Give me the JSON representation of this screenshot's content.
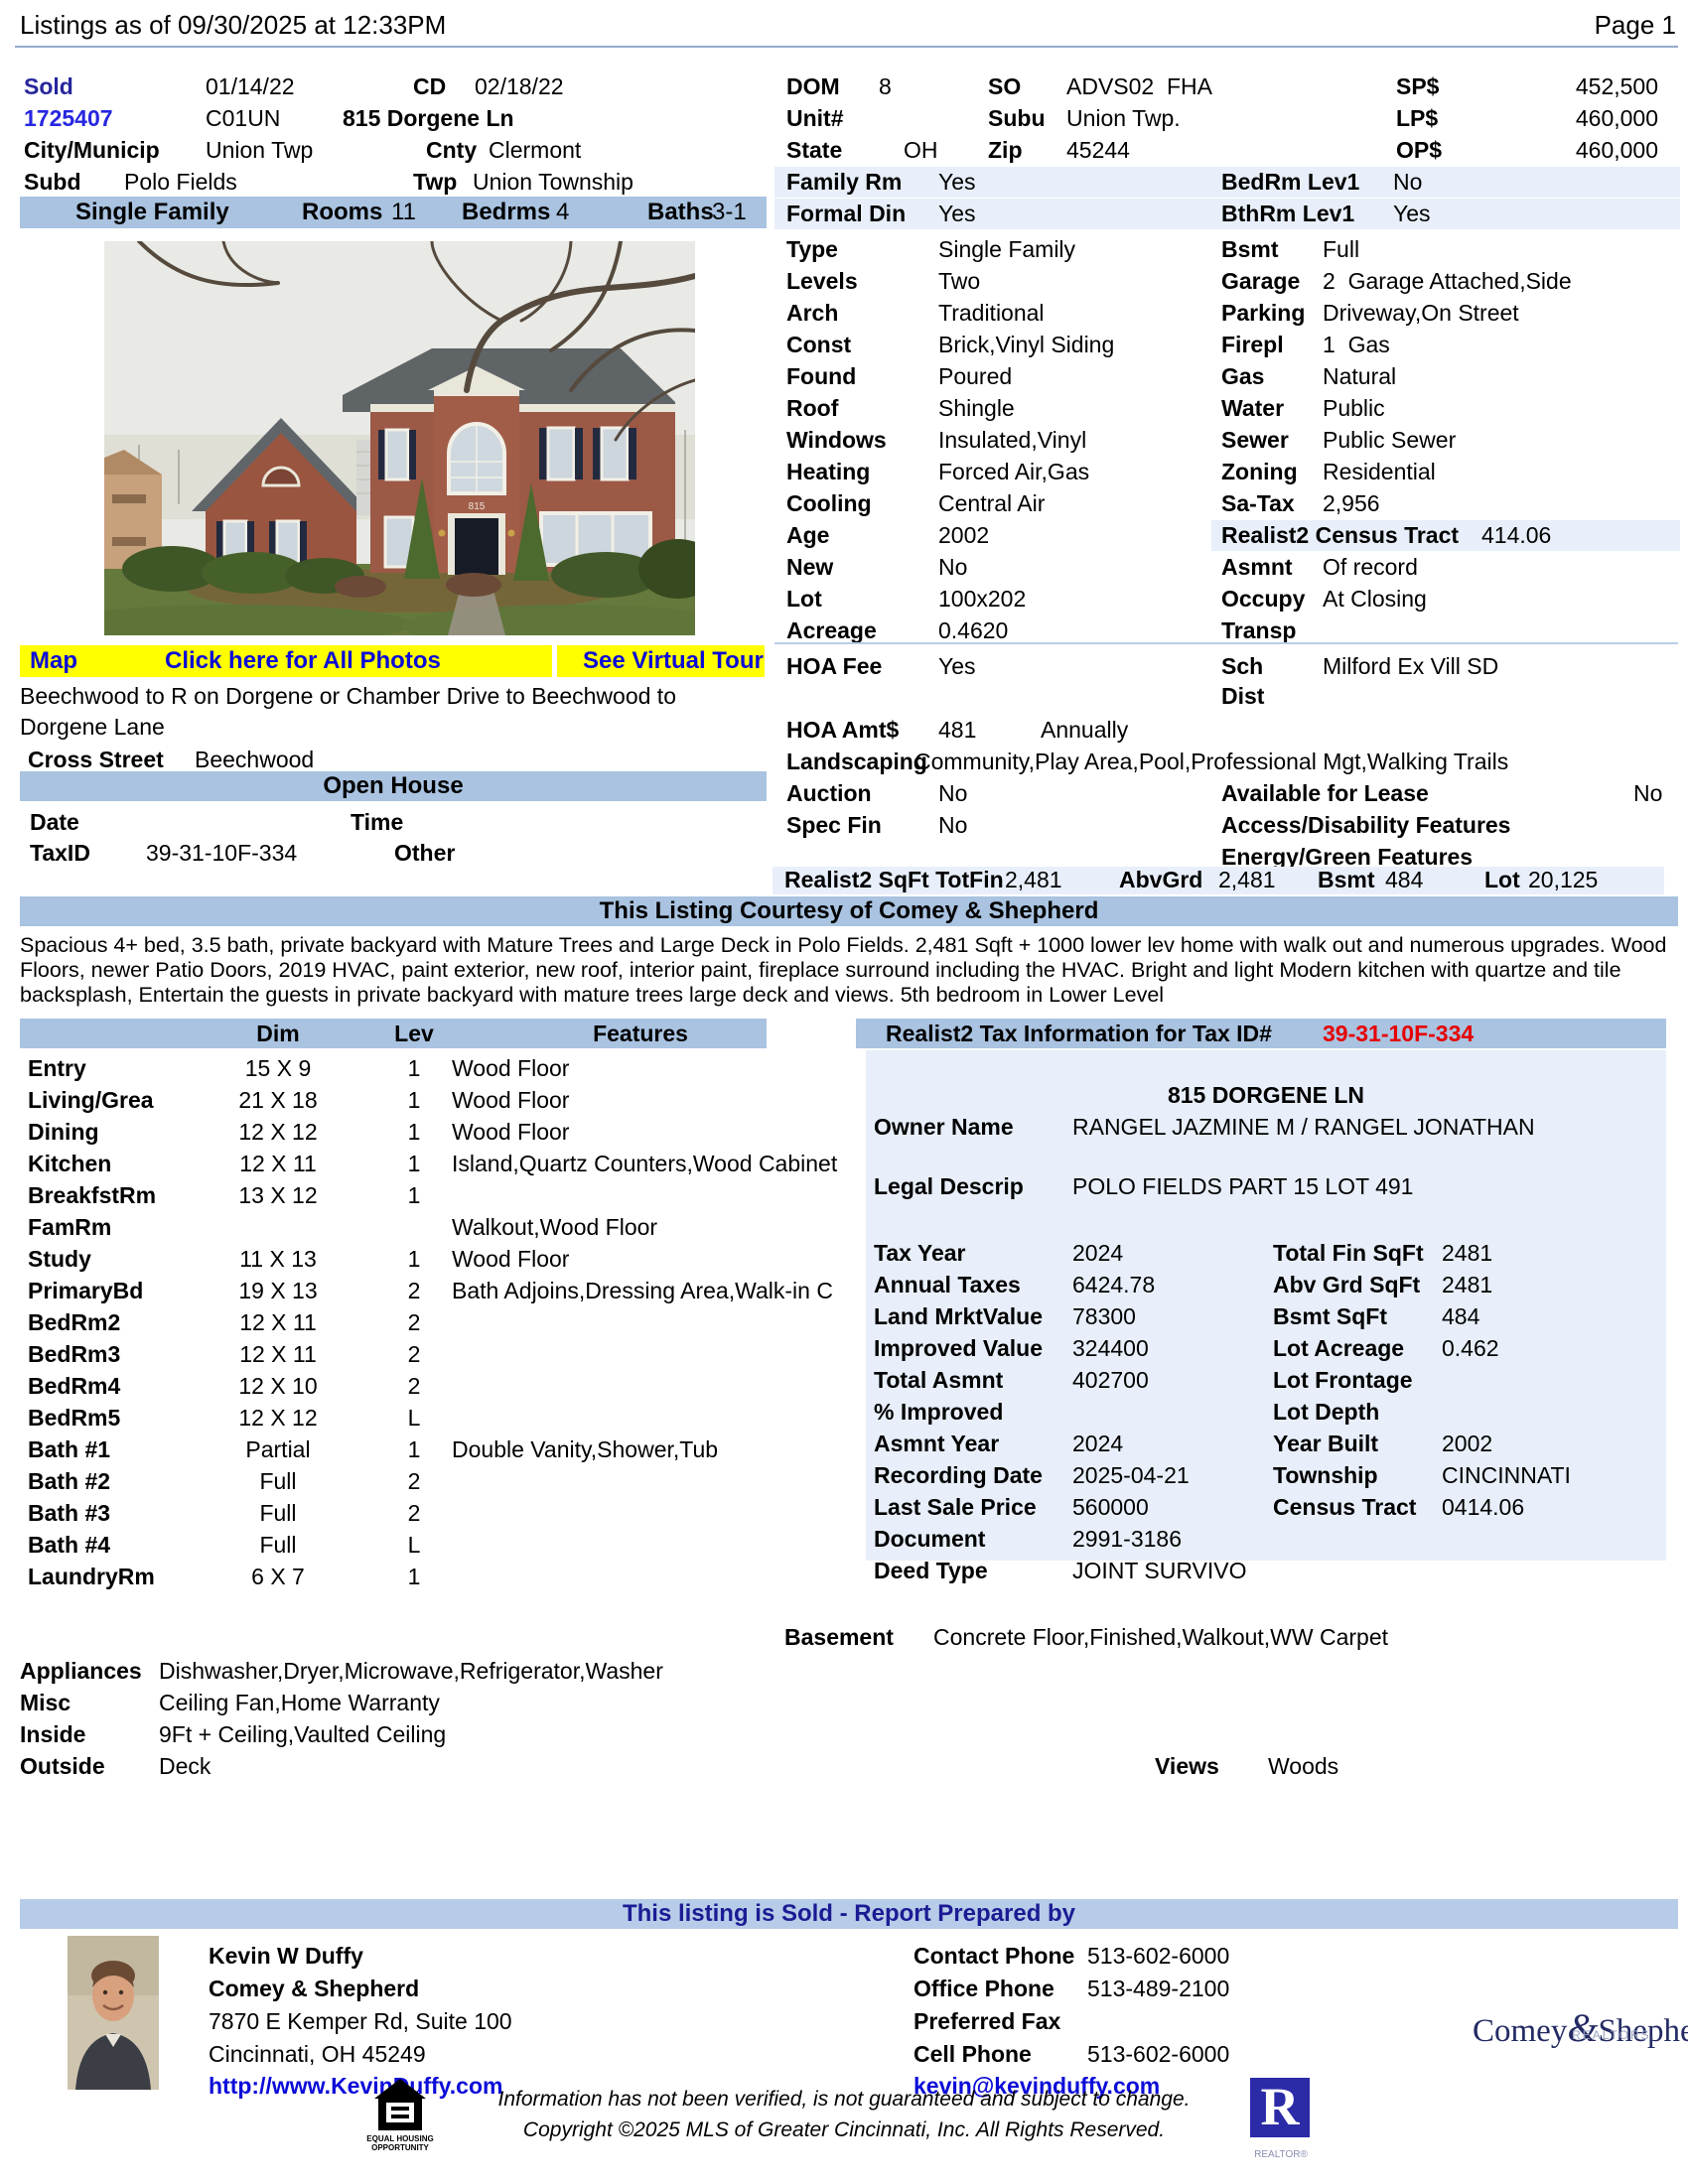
{
  "header": {
    "listings_as_of": "Listings as of 09/30/2025 at 12:33PM",
    "page": "Page 1"
  },
  "colors": {
    "band_blue": "#a9c3e1",
    "highlight_blue": "#e8effa",
    "link_blue": "#0b0bd8",
    "sold_navy": "#26269c",
    "alert_red": "#e60000",
    "photo_bar_yellow": "#ffff00"
  },
  "summary": {
    "status": "Sold",
    "list_date": "01/14/22",
    "cd_label": "CD",
    "cd_date": "02/18/22",
    "mls_number": "1725407",
    "area_code": "C01UN",
    "address": "815 Dorgene Ln",
    "city_label": "City/Municip",
    "city": "Union Twp",
    "county_label": "Cnty",
    "county": "Clermont",
    "subd_label": "Subd",
    "subd": "Polo Fields",
    "twp_label": "Twp",
    "twp": "Union Township",
    "type": "Single Family",
    "rooms_label": "Rooms",
    "rooms": "11",
    "bedrms_label": "Bedrms",
    "bedrms": "4",
    "baths_label": "Baths",
    "baths": "3-1",
    "dom_label": "DOM",
    "dom": "8",
    "so_label": "SO",
    "so": "ADVS02  FHA",
    "unit_label": "Unit#",
    "subu_label": "Subu",
    "subu": "Union Twp.",
    "state_label": "State",
    "state": "OH",
    "zip_label": "Zip",
    "zip": "45244",
    "sp_label": "SP$",
    "sp": "452,500",
    "lp_label": "LP$",
    "lp": "460,000",
    "op_label": "OP$",
    "op": "460,000"
  },
  "right_rows": [
    {
      "l1": "Family Rm",
      "v1": "Yes",
      "l2": "BedRm Lev1",
      "v2": "No",
      "hl": "full",
      "v2x": 623
    },
    {
      "l1": "Formal Din",
      "v1": "Yes",
      "l2": "BthRm Lev1",
      "v2": "Yes",
      "hl": "full",
      "v2x": 623
    },
    {
      "l1": "Type",
      "v1": "Single Family",
      "l2": "Bsmt",
      "v2": "Full"
    },
    {
      "l1": "Levels",
      "v1": "Two",
      "l2": "Garage",
      "v2": "2  Garage Attached,Side"
    },
    {
      "l1": "Arch",
      "v1": "Traditional",
      "l2": "Parking",
      "v2": "Driveway,On Street"
    },
    {
      "l1": "Const",
      "v1": "Brick,Vinyl Siding",
      "l2": "Firepl",
      "v2": "1  Gas"
    },
    {
      "l1": "Found",
      "v1": "Poured",
      "l2": "Gas",
      "v2": "Natural"
    },
    {
      "l1": "Roof",
      "v1": "Shingle",
      "l2": "Water",
      "v2": "Public"
    },
    {
      "l1": "Windows",
      "v1": "Insulated,Vinyl",
      "l2": "Sewer",
      "v2": "Public Sewer"
    },
    {
      "l1": "Heating",
      "v1": "Forced Air,Gas",
      "l2": "Zoning",
      "v2": "Residential"
    },
    {
      "l1": "Cooling",
      "v1": "Central Air",
      "l2": "Sa-Tax",
      "v2": "2,956"
    },
    {
      "l1": "Age",
      "v1": "2002",
      "l2": "Realist2 Census Tract",
      "v2": "414.06",
      "hl": "right",
      "v2x": 712
    },
    {
      "l1": "New",
      "v1": "No",
      "l2": "Asmnt",
      "v2": "Of record"
    },
    {
      "l1": "Lot",
      "v1": "100x202",
      "l2": "Occupy",
      "v2": "At Closing"
    },
    {
      "l1": "Acreage",
      "v1": "0.4620",
      "l2": "Transp",
      "v2": ""
    }
  ],
  "hoa": {
    "fee_label": "HOA Fee",
    "fee": "Yes",
    "sch_label": "Sch",
    "dist_label": "Dist",
    "sch_value": "Milford Ex Vill SD",
    "amt_label": "HOA Amt$",
    "amt": "481",
    "amt_freq": "Annually",
    "landscaping_label": "Landscaping",
    "landscaping": "Community,Play Area,Pool,Professional Mgt,Walking Trails",
    "auction_label": "Auction",
    "auction": "No",
    "lease_label": "Available for Lease",
    "lease": "No",
    "specfin_label": "Spec Fin",
    "specfin": "No",
    "access_label": "Access/Disability Features",
    "energy_label": "Energy/Green Features"
  },
  "sqft": {
    "label": "Realist2 SqFt TotFin",
    "totfin": "2,481",
    "abvgrd_label": "AbvGrd",
    "abvgrd": "2,481",
    "bsmt_label": "Bsmt",
    "bsmt": "484",
    "lot_label": "Lot",
    "lot": "20,125"
  },
  "photo": {
    "house_number": "815"
  },
  "photo_bar": {
    "map": "Map",
    "all_photos": "Click here for All Photos",
    "virtual_tour": "See Virtual Tour"
  },
  "location": {
    "directions": "Beechwood to R on Dorgene or Chamber Drive to Beechwood to Dorgene Lane",
    "cross_street_label": "Cross Street",
    "cross_street": "Beechwood"
  },
  "open_house": {
    "title": "Open House",
    "date_label": "Date",
    "time_label": "Time",
    "taxid_label": "TaxID",
    "taxid": "39-31-10F-334",
    "other_label": "Other"
  },
  "courtesy": "This Listing Courtesy of Comey & Shepherd",
  "remarks": "Spacious 4+ bed, 3.5 bath, private backyard with Mature Trees and Large Deck in Polo Fields. 2,481 Sqft + 1000 lower lev home with walk out and numerous upgrades. Wood Floors, newer Patio Doors, 2019 HVAC, paint exterior, new roof, interior paint, fireplace surround including the HVAC. Bright and light Modern kitchen with quartze and tile backsplash, Entertain the guests in private backyard with mature trees large deck and views. 5th bedroom in Lower Level",
  "room_table": {
    "dim_header": "Dim",
    "lev_header": "Lev",
    "features_header": "Features",
    "rows": [
      {
        "name": "Entry",
        "dim": "15 X 9",
        "lev": "1",
        "feat": "Wood Floor"
      },
      {
        "name": "Living/Grea",
        "dim": "21 X 18",
        "lev": "1",
        "feat": "Wood Floor"
      },
      {
        "name": "Dining",
        "dim": "12 X 12",
        "lev": "1",
        "feat": "Wood Floor"
      },
      {
        "name": "Kitchen",
        "dim": "12 X 11",
        "lev": "1",
        "feat": "Island,Quartz Counters,Wood Cabinet"
      },
      {
        "name": "BreakfstRm",
        "dim": "13 X 12",
        "lev": "1",
        "feat": ""
      },
      {
        "name": "FamRm",
        "dim": "",
        "lev": "",
        "feat": "Walkout,Wood Floor"
      },
      {
        "name": "Study",
        "dim": "11 X 13",
        "lev": "1",
        "feat": "Wood Floor"
      },
      {
        "name": "PrimaryBd",
        "dim": "19 X 13",
        "lev": "2",
        "feat": "Bath Adjoins,Dressing Area,Walk-in C"
      },
      {
        "name": "BedRm2",
        "dim": "12 X 11",
        "lev": "2",
        "feat": ""
      },
      {
        "name": "BedRm3",
        "dim": "12 X 11",
        "lev": "2",
        "feat": ""
      },
      {
        "name": "BedRm4",
        "dim": "12 X 10",
        "lev": "2",
        "feat": ""
      },
      {
        "name": "BedRm5",
        "dim": "12 X 12",
        "lev": "L",
        "feat": ""
      },
      {
        "name": "Bath #1",
        "dim": "Partial",
        "lev": "1",
        "feat": "Double Vanity,Shower,Tub"
      },
      {
        "name": "Bath #2",
        "dim": "Full",
        "lev": "2",
        "feat": ""
      },
      {
        "name": "Bath #3",
        "dim": "Full",
        "lev": "2",
        "feat": ""
      },
      {
        "name": "Bath #4",
        "dim": "Full",
        "lev": "L",
        "feat": ""
      },
      {
        "name": "LaundryRm",
        "dim": "6 X 7",
        "lev": "1",
        "feat": ""
      }
    ]
  },
  "tax": {
    "title": "Realist2 Tax Information for Tax ID# ",
    "taxid": "39-31-10F-334",
    "site_address": "815 DORGENE LN",
    "owner_label": "Owner Name",
    "owner": "RANGEL JAZMINE M / RANGEL JONATHAN",
    "legal_label": "Legal Descrip",
    "legal": "POLO FIELDS PART 15 LOT 491",
    "left_rows": [
      {
        "label": "Tax Year",
        "value": "2024"
      },
      {
        "label": "Annual Taxes",
        "value": "6424.78"
      },
      {
        "label": "Land MrktValue",
        "value": "78300"
      },
      {
        "label": "Improved Value",
        "value": "324400"
      },
      {
        "label": "Total Asmnt",
        "value": "402700"
      },
      {
        "label": "% Improved",
        "value": ""
      },
      {
        "label": "Asmnt Year",
        "value": "2024"
      },
      {
        "label": "Recording Date",
        "value": "2025-04-21"
      },
      {
        "label": "Last Sale Price",
        "value": "560000"
      },
      {
        "label": "Document",
        "value": "2991-3186"
      },
      {
        "label": "Deed Type",
        "value": "JOINT SURVIVO"
      }
    ],
    "right_rows": [
      {
        "label": "Total Fin SqFt",
        "value": "2481"
      },
      {
        "label": "Abv Grd SqFt",
        "value": "2481"
      },
      {
        "label": "Bsmt SqFt",
        "value": "484"
      },
      {
        "label": "Lot Acreage",
        "value": "0.462"
      },
      {
        "label": "Lot Frontage",
        "value": ""
      },
      {
        "label": "Lot Depth",
        "value": ""
      },
      {
        "label": "Year Built",
        "value": "2002"
      },
      {
        "label": "Township",
        "value": "CINCINNATI"
      },
      {
        "label": "Census Tract",
        "value": "0414.06"
      }
    ]
  },
  "features": {
    "basement_label": "Basement",
    "basement": "Concrete Floor,Finished,Walkout,WW Carpet",
    "appliances_label": "Appliances",
    "appliances": "Dishwasher,Dryer,Microwave,Refrigerator,Washer",
    "misc_label": "Misc",
    "misc": "Ceiling Fan,Home Warranty",
    "inside_label": "Inside",
    "inside": "9Ft + Ceiling,Vaulted Ceiling",
    "outside_label": "Outside",
    "outside": "Deck",
    "views_label": "Views",
    "views": "Woods"
  },
  "report": {
    "band": "This listing is Sold - Report Prepared by",
    "agent_name": "Kevin W Duffy",
    "agency": "Comey & Shepherd",
    "address1": "7870 E Kemper Rd, Suite 100",
    "address2": "Cincinnati, OH 45249",
    "website": "http://www.KevinDuffy.com",
    "email": "kevin@kevinduffy.com",
    "contact_phone_label": "Contact Phone",
    "contact_phone": "513-602-6000",
    "office_phone_label": "Office Phone",
    "office_phone": "513-489-2100",
    "fax_label": "Preferred Fax",
    "cell_label": "Cell Phone",
    "cell_phone": "513-602-6000",
    "brand_name": "Comey",
    "brand_amp": "&",
    "brand_name2": "Shepherd",
    "brand_sub": "REALTORS.",
    "disclaimer1": "Information has not been verified, is not guaranteed and subject to change.",
    "disclaimer2": "Copyright ©2025 MLS of Greater Cincinnati, Inc. All Rights Reserved.",
    "eho_line1": "EQUAL HOUSING",
    "eho_line2": "OPPORTUNITY",
    "realtor_r": "R",
    "realtor_caption": "REALTOR®"
  }
}
